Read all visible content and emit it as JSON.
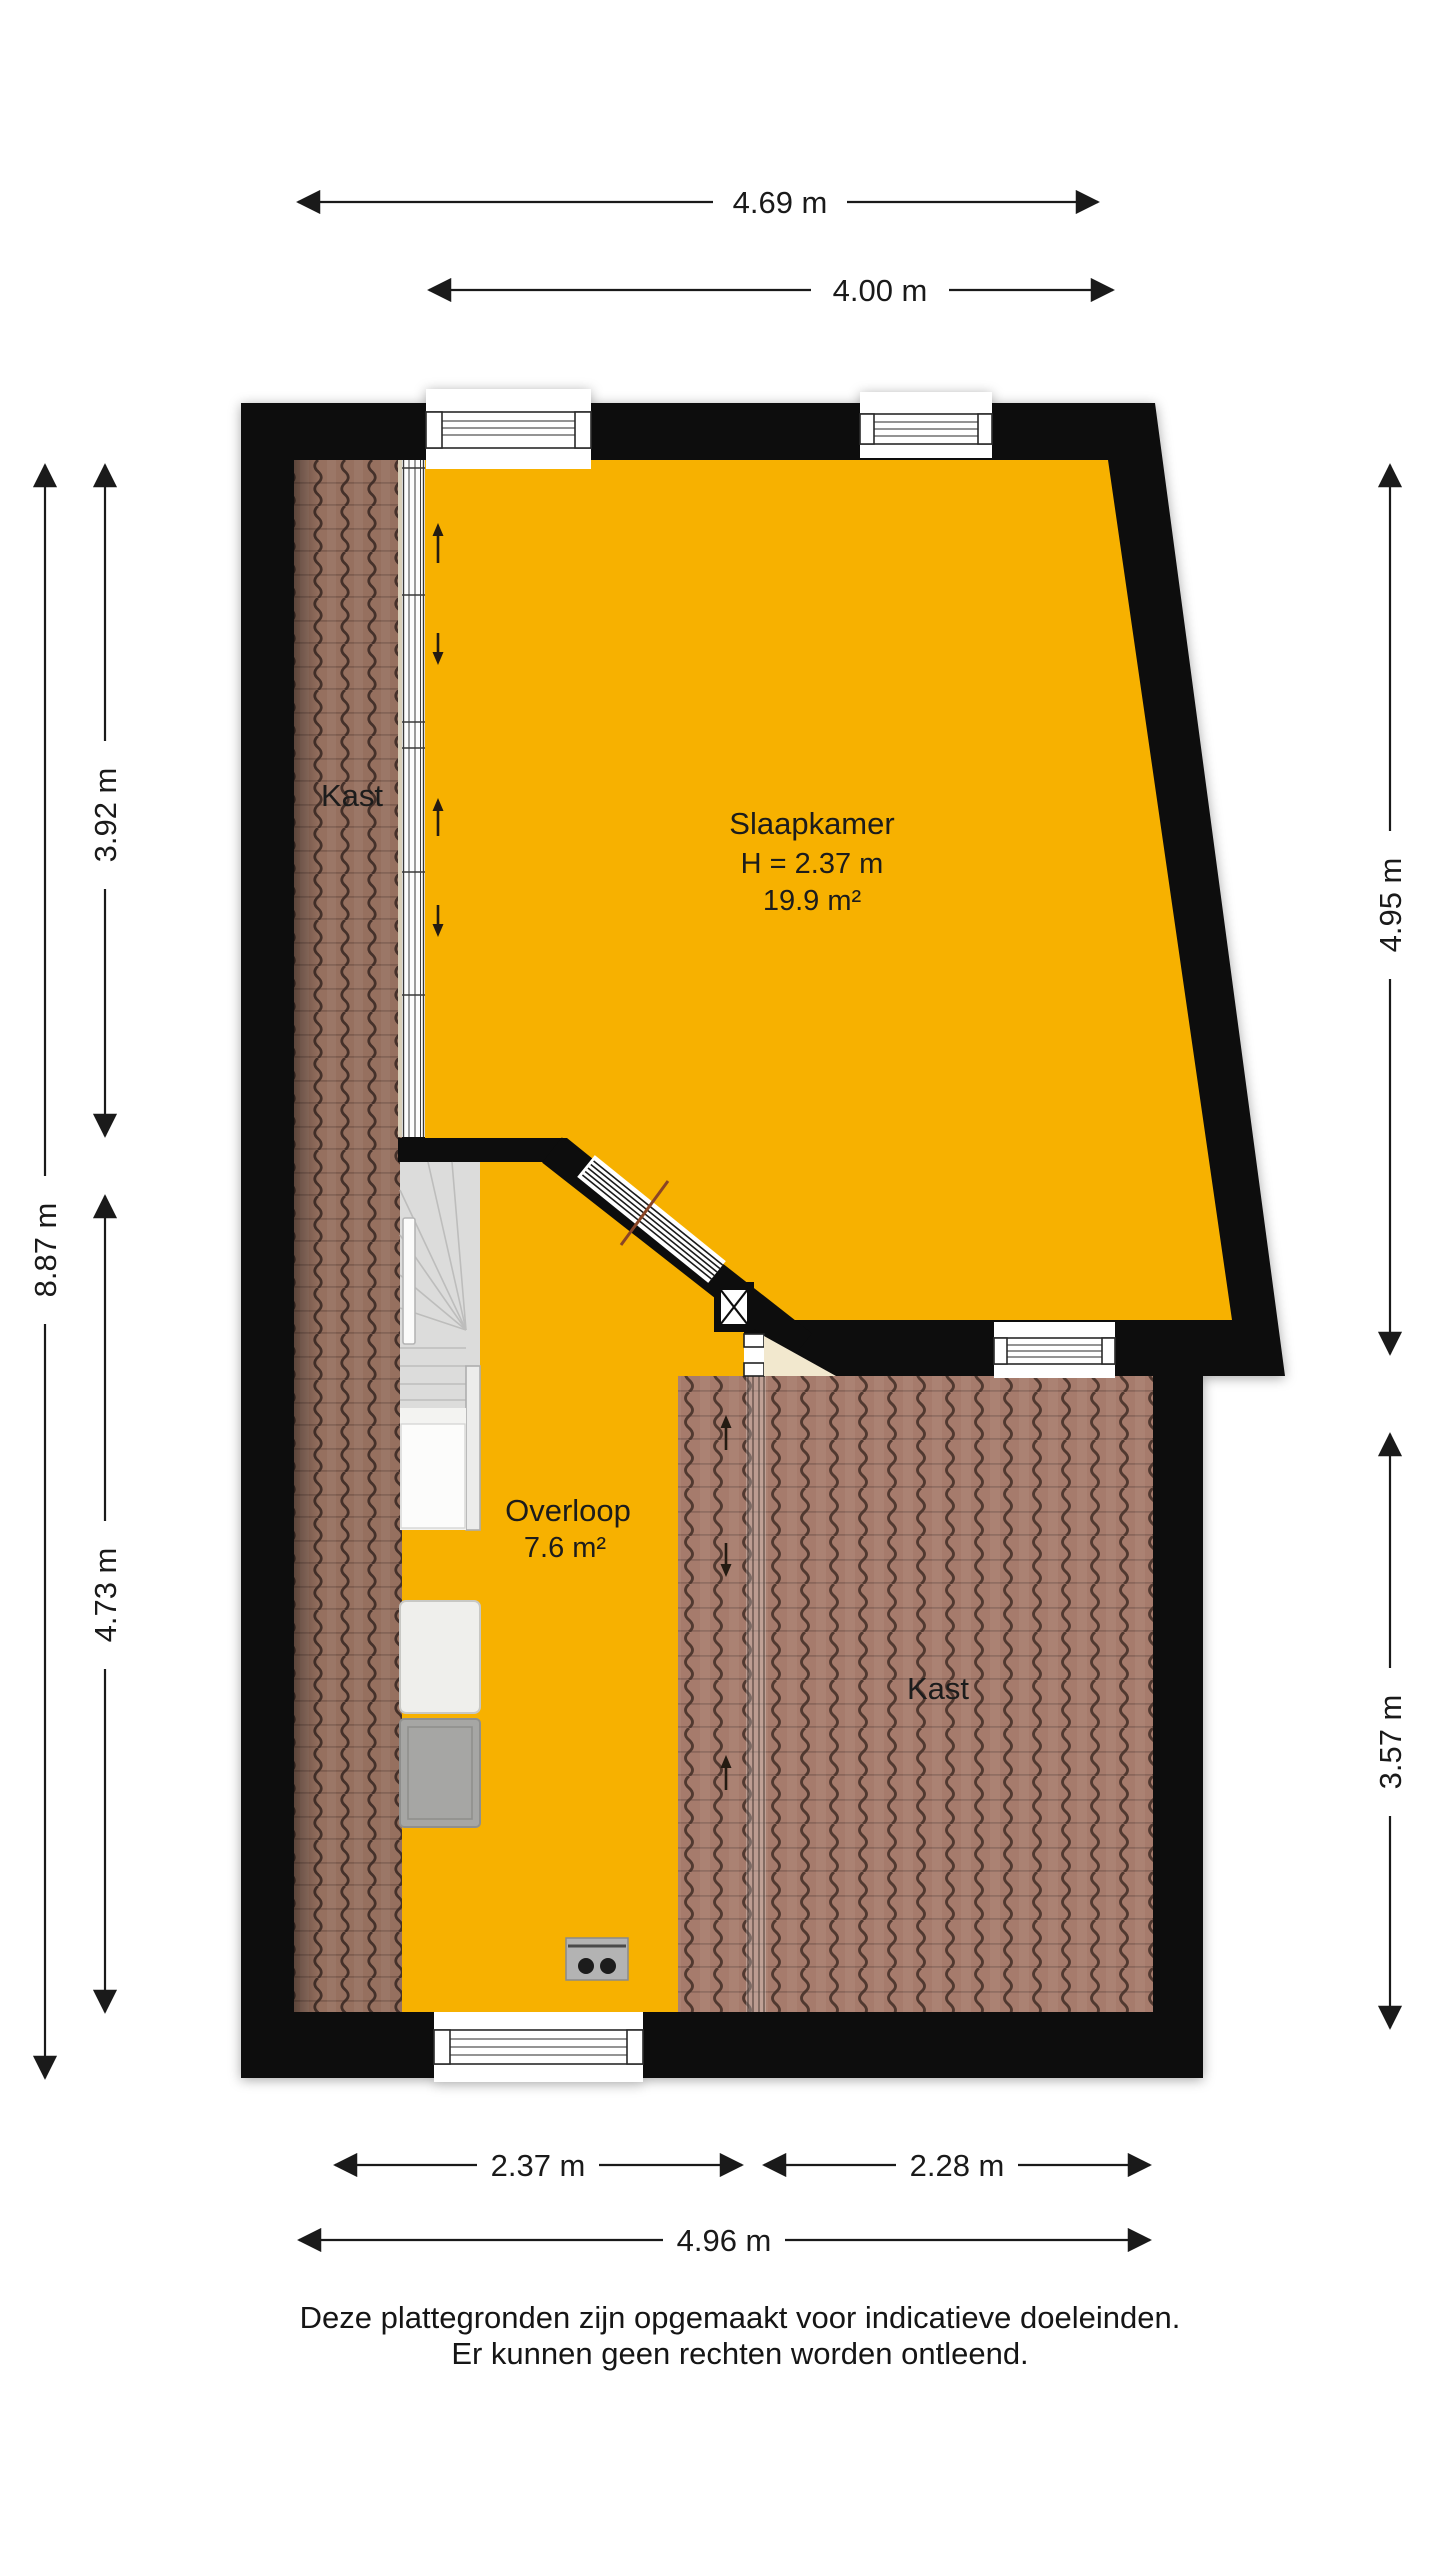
{
  "rooms": {
    "slaapkamer": {
      "name": "Slaapkamer",
      "height_label": "H = 2.37 m",
      "area_label": "19.9 m²"
    },
    "overloop": {
      "name": "Overloop",
      "area_label": "7.6 m²"
    },
    "kast_upper": {
      "name": "Kast"
    },
    "kast_lower": {
      "name": "Kast"
    }
  },
  "dimensions": {
    "top_outer": "4.69 m",
    "top_inner": "4.00 m",
    "left_outer": "8.87 m",
    "left_upper": "3.92 m",
    "left_lower": "4.73 m",
    "right_upper": "4.95 m",
    "right_lower": "3.57 m",
    "bottom_left": "2.37 m",
    "bottom_right": "2.28 m",
    "bottom_outer": "4.96 m"
  },
  "disclaimer": {
    "line1": "Deze plattegronden zijn opgemaakt voor indicatieve doeleinden.",
    "line2": "Er kunnen geen rechten worden ontleend."
  },
  "colors": {
    "floor_orange": "#F7B100",
    "wall_black": "#0D0D0D",
    "tile_left": "#96705F",
    "tile_right": "#A67B6C",
    "beige": "#F2E8CE"
  }
}
